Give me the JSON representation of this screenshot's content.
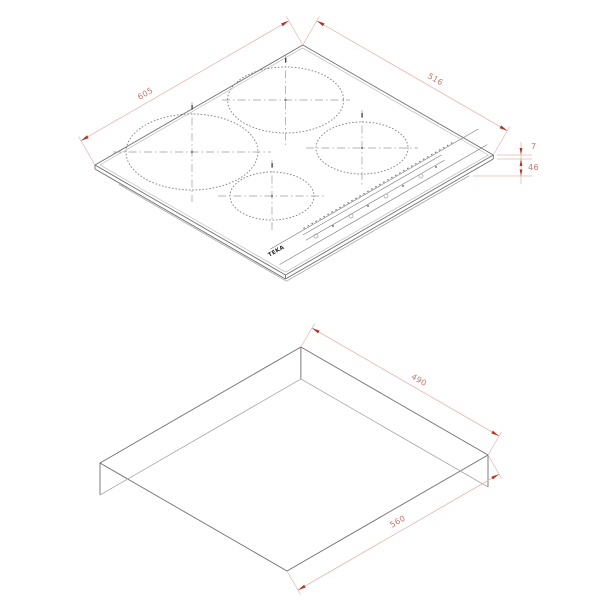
{
  "colors": {
    "dimension_red": "#b4342a",
    "dimension_text": "#c4766b",
    "dimension_line": "#e3b7b0",
    "outline_gray": "#6f6f6f",
    "background": "#ffffff"
  },
  "hob_view": {
    "brand_label": "TEKA",
    "dimensions": {
      "width": "605",
      "depth": "516",
      "glass_height": "7",
      "build_in_depth": "46"
    }
  },
  "cutout_view": {
    "dimensions": {
      "depth": "490",
      "width": "560"
    }
  }
}
